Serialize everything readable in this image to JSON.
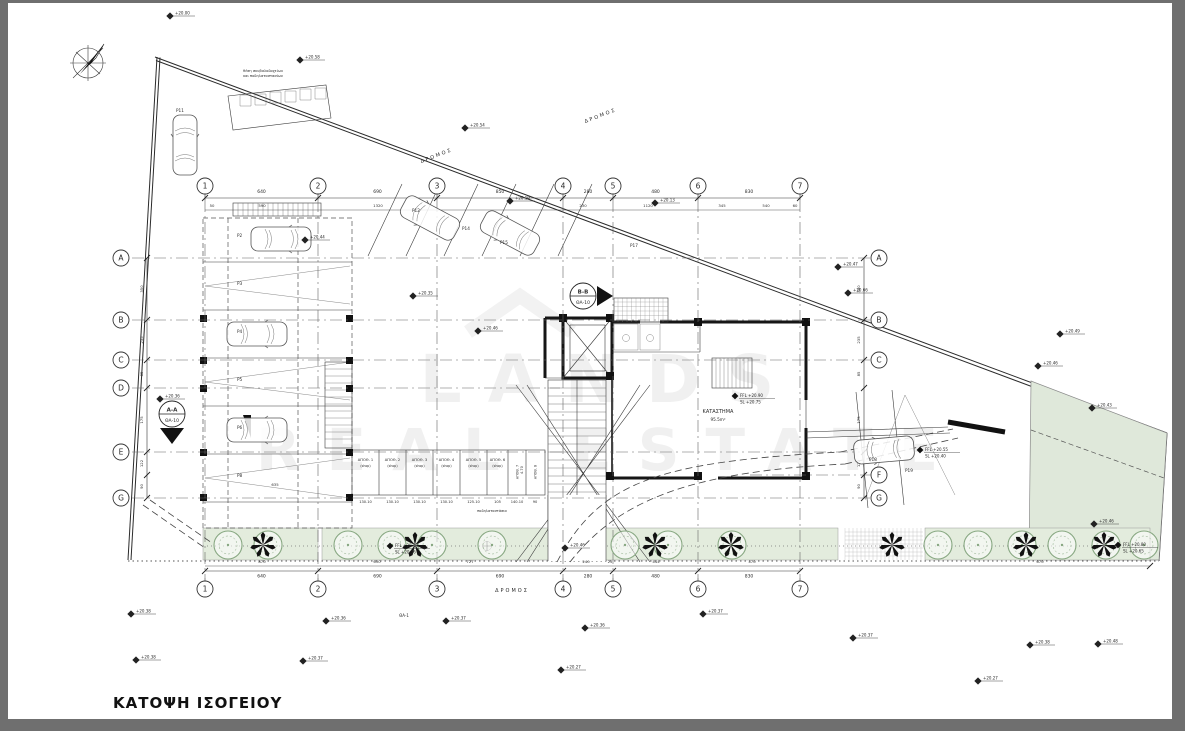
{
  "page": {
    "title": "ΚΑΤΟΨΗ ΙΣΟΓΕΙΟΥ",
    "frame_color": "#6f6f6f",
    "paper_color": "#ffffff",
    "line_color": "#2b2b2b",
    "plant_green": "#e3ecdd",
    "tree_green": "#87a781",
    "area_green": "#dfe8da"
  },
  "watermark": {
    "line1": "LANDS",
    "line2": "REAL ESTATE"
  },
  "compass": {
    "icon": "north-arrow-icon"
  },
  "grid": {
    "cols": [
      {
        "label": "1",
        "x": 205
      },
      {
        "label": "2",
        "x": 318
      },
      {
        "label": "3",
        "x": 437
      },
      {
        "label": "4",
        "x": 563
      },
      {
        "label": "5",
        "x": 613
      },
      {
        "label": "6",
        "x": 698
      },
      {
        "label": "7",
        "x": 800
      }
    ],
    "col_bubble_top_y": 186,
    "col_bubble_bottom_y": 589,
    "col_line_y1": 200,
    "col_line_y2": 578,
    "rows": [
      {
        "label": "A",
        "y": 258,
        "left": true,
        "right": true,
        "x1": 132,
        "x2": 876
      },
      {
        "label": "B",
        "y": 320,
        "left": true,
        "right": true,
        "x1": 132,
        "x2": 876
      },
      {
        "label": "C",
        "y": 360,
        "left": true,
        "right": true,
        "x1": 132,
        "x2": 876
      },
      {
        "label": "D",
        "y": 388,
        "left": true,
        "right": false,
        "x1": 132,
        "x2": 560
      },
      {
        "label": "E",
        "y": 452,
        "left": true,
        "right": false,
        "x1": 132,
        "x2": 860
      },
      {
        "label": "F",
        "y": 475,
        "left": false,
        "right": true,
        "x1": 750,
        "x2": 876
      },
      {
        "label": "G",
        "y": 498,
        "left": true,
        "right": true,
        "x1": 132,
        "x2": 876
      }
    ],
    "row_bubble_left_x": 121,
    "row_bubble_right_x": 879
  },
  "dimensions": {
    "top_main": [
      "640",
      "690",
      "850",
      "280",
      "480",
      "830"
    ],
    "top_sub": [
      {
        "t": "50",
        "x": 212
      },
      {
        "t": "590",
        "x": 262
      },
      {
        "t": "1320",
        "x": 378
      },
      {
        "t": "230",
        "x": 583
      },
      {
        "t": "1120",
        "x": 648
      },
      {
        "t": "345",
        "x": 722
      },
      {
        "t": "540",
        "x": 766
      },
      {
        "t": "60",
        "x": 795
      }
    ],
    "bottom_main": [
      "640",
      "690",
      "690",
      "280",
      "480",
      "830"
    ],
    "bottom_sub": [
      {
        "t": "870",
        "x": 262
      },
      {
        "t": "630",
        "x": 377
      },
      {
        "t": "727",
        "x": 470
      },
      {
        "t": "240",
        "x": 586
      },
      {
        "t": "25",
        "x": 610
      },
      {
        "t": "444",
        "x": 656
      },
      {
        "t": "470",
        "x": 752
      },
      {
        "t": "670",
        "x": 1040
      }
    ],
    "left_rows": [
      "350",
      "235",
      "85",
      "175",
      "122",
      "90"
    ],
    "right_rows": [
      "350",
      "235",
      "85",
      "175",
      "122",
      "90"
    ]
  },
  "spot_levels": [
    {
      "x": 170,
      "y": 16,
      "v": "+20.00"
    },
    {
      "x": 300,
      "y": 60,
      "v": "+20.58"
    },
    {
      "x": 465,
      "y": 128,
      "v": "+20.54"
    },
    {
      "x": 510,
      "y": 201,
      "v": "+20.19"
    },
    {
      "x": 655,
      "y": 203,
      "v": "+20.13"
    },
    {
      "x": 838,
      "y": 267,
      "v": "+20.47"
    },
    {
      "x": 848,
      "y": 293,
      "v": "+20.66"
    },
    {
      "x": 1060,
      "y": 334,
      "v": "+20.49"
    },
    {
      "x": 1038,
      "y": 366,
      "v": "+20.46"
    },
    {
      "x": 1092,
      "y": 408,
      "v": "+20.43"
    },
    {
      "x": 1094,
      "y": 524,
      "v": "+20.46"
    },
    {
      "x": 413,
      "y": 296,
      "v": "+20.35"
    },
    {
      "x": 478,
      "y": 331,
      "v": "+20.46"
    },
    {
      "x": 160,
      "y": 399,
      "v": "+20.36"
    },
    {
      "x": 305,
      "y": 240,
      "v": "+20.44"
    },
    {
      "x": 131,
      "y": 614,
      "v": "+20.38"
    },
    {
      "x": 326,
      "y": 621,
      "v": "+20.36"
    },
    {
      "x": 446,
      "y": 621,
      "v": "+20.37"
    },
    {
      "x": 585,
      "y": 628,
      "v": "+20.36"
    },
    {
      "x": 136,
      "y": 660,
      "v": "+20.38"
    },
    {
      "x": 303,
      "y": 661,
      "v": "+20.37"
    },
    {
      "x": 561,
      "y": 670,
      "v": "+20.27"
    },
    {
      "x": 703,
      "y": 614,
      "v": "+20.37"
    },
    {
      "x": 853,
      "y": 638,
      "v": "+20.37"
    },
    {
      "x": 1030,
      "y": 645,
      "v": "+20.38"
    },
    {
      "x": 978,
      "y": 681,
      "v": "+20.27"
    },
    {
      "x": 1098,
      "y": 644,
      "v": "+20.48"
    },
    {
      "x": 565,
      "y": 548,
      "v": "+20.46"
    }
  ],
  "ffl_labels": [
    {
      "x": 735,
      "y": 396,
      "l1": "FFL +20.90",
      "l2": "SL +20.75"
    },
    {
      "x": 920,
      "y": 450,
      "l1": "FFL +20.55",
      "l2": "SL +20.40"
    },
    {
      "x": 1118,
      "y": 545,
      "l1": "FFL +20.80",
      "l2": "SL +20.65"
    },
    {
      "x": 390,
      "y": 546,
      "l1": "FFL +20.48",
      "l2": "SL +20.36"
    }
  ],
  "sections": [
    {
      "name": "A-A",
      "sheet": "ΘΑ-10",
      "x": 172,
      "y": 414,
      "dir": "down"
    },
    {
      "name": "B-B",
      "sheet": "ΘΑ-10",
      "x": 583,
      "y": 296,
      "dir": "right"
    }
  ],
  "storage": {
    "cells": [
      {
        "name": "ΑΠΟΘ. 1",
        "sub": "(shop)",
        "dim": "130.10"
      },
      {
        "name": "ΑΠΟΘ. 2",
        "sub": "(shop)",
        "dim": "130.10"
      },
      {
        "name": "ΑΠΟΘ. 3",
        "sub": "(shop)",
        "dim": "130.10"
      },
      {
        "name": "ΑΠΟΘ. 4",
        "sub": "(shop)",
        "dim": "130.10"
      },
      {
        "name": "ΑΠΟΘ. 5",
        "sub": "(shop)",
        "dim": "125.10"
      },
      {
        "name": "ΑΠΟΘ. 6",
        "sub": "(shop)",
        "dim": "105"
      },
      {
        "name": "ΑΠΟΘ. 7",
        "sub": "",
        "dim": "140.10",
        "vertical": true
      },
      {
        "name": "ΑΠΟΘ. 8",
        "sub": "",
        "dim": "90",
        "vertical": true
      }
    ]
  },
  "shop": {
    "name": "ΚΑΤΑΣΤΗΜΑ",
    "area": "95.5m²"
  },
  "road_labels": [
    {
      "text": "ΔΡΟΜΟΣ",
      "x": 437,
      "y": 157,
      "rot": -21
    },
    {
      "text": "ΔΡΟΜΟΣ",
      "x": 601,
      "y": 117,
      "rot": -21
    },
    {
      "text": "ΔΡΟΜΟΣ",
      "x": 512,
      "y": 592,
      "rot": 0
    }
  ],
  "parking_labels": [
    {
      "t": "P11",
      "x": 176,
      "y": 112
    },
    {
      "t": "P2",
      "x": 237,
      "y": 237
    },
    {
      "t": "P3",
      "x": 237,
      "y": 285
    },
    {
      "t": "P4",
      "x": 237,
      "y": 333
    },
    {
      "t": "P5",
      "x": 237,
      "y": 381
    },
    {
      "t": "P6",
      "x": 237,
      "y": 429
    },
    {
      "t": "P8",
      "x": 237,
      "y": 477
    },
    {
      "t": "P12",
      "x": 412,
      "y": 212
    },
    {
      "t": "P14",
      "x": 462,
      "y": 230
    },
    {
      "t": "P15",
      "x": 500,
      "y": 244
    },
    {
      "t": "P17",
      "x": 630,
      "y": 247
    },
    {
      "t": "P18",
      "x": 869,
      "y": 461
    },
    {
      "t": "P19",
      "x": 905,
      "y": 472
    }
  ],
  "notes": [
    {
      "t": "θέση σκυβαλοδοχείων",
      "x": 263,
      "y": 72,
      "s": 3.6
    },
    {
      "t": "και ποδηλατοστασίων",
      "x": 263,
      "y": 77,
      "s": 3.6
    },
    {
      "t": "ΘΑ-1",
      "x": 404,
      "y": 617,
      "s": 4
    },
    {
      "t": "ποδηλατοστάσια",
      "x": 492,
      "y": 512,
      "s": 3.5
    },
    {
      "t": "635",
      "x": 275,
      "y": 486,
      "s": 3.8
    },
    {
      "t": "4.70",
      "x": 523,
      "y": 470,
      "s": 3.5,
      "rot": -90
    }
  ],
  "trees": {
    "green_x": [
      228,
      268,
      348,
      392,
      432,
      492,
      625,
      668,
      732,
      938,
      978,
      1022,
      1062,
      1106,
      1144
    ],
    "palm_x": [
      263,
      415,
      655,
      731,
      892,
      1026,
      1104
    ],
    "y": 545
  },
  "cars": [
    {
      "x": 185,
      "y": 145,
      "r": 0
    },
    {
      "x": 281,
      "y": 239,
      "r": 90
    },
    {
      "x": 257,
      "y": 334,
      "r": 90
    },
    {
      "x": 257,
      "y": 430,
      "r": 90
    },
    {
      "x": 430,
      "y": 218,
      "r": -62
    },
    {
      "x": 510,
      "y": 233,
      "r": -62
    },
    {
      "x": 884,
      "y": 450,
      "r": -95
    }
  ]
}
